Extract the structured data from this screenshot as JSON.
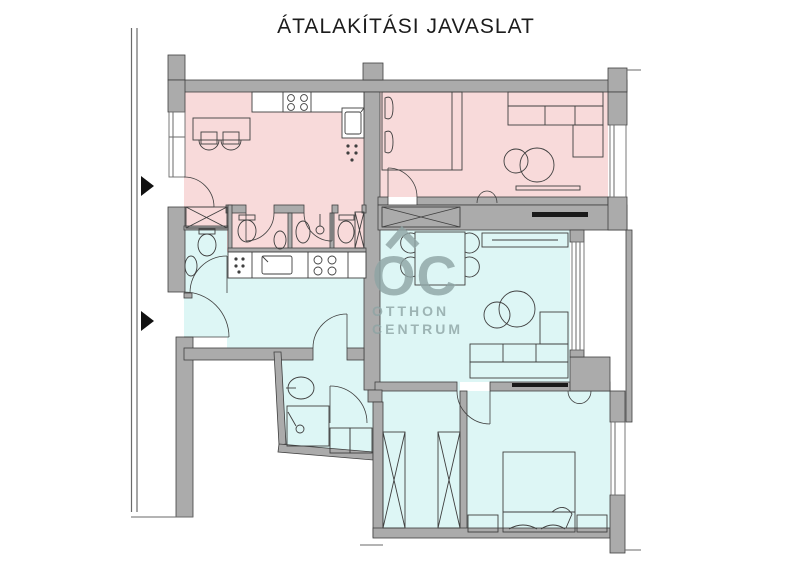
{
  "title": "ÁTALAKÍTÁSI JAVASLAT",
  "watermark": {
    "logo_letters": "OC",
    "line1": "OTTHON",
    "line2": "CENTRUM"
  },
  "colors": {
    "paper": "#ffffff",
    "existing_pink": "#f8dada",
    "proposed_blue": "#ddf6f5",
    "wall": "#ababab",
    "outline": "#3f3f3f",
    "watermark": "#8ea4a4",
    "threshold_black": "#1a1a1a",
    "property_line": "#6a6a6a"
  }
}
